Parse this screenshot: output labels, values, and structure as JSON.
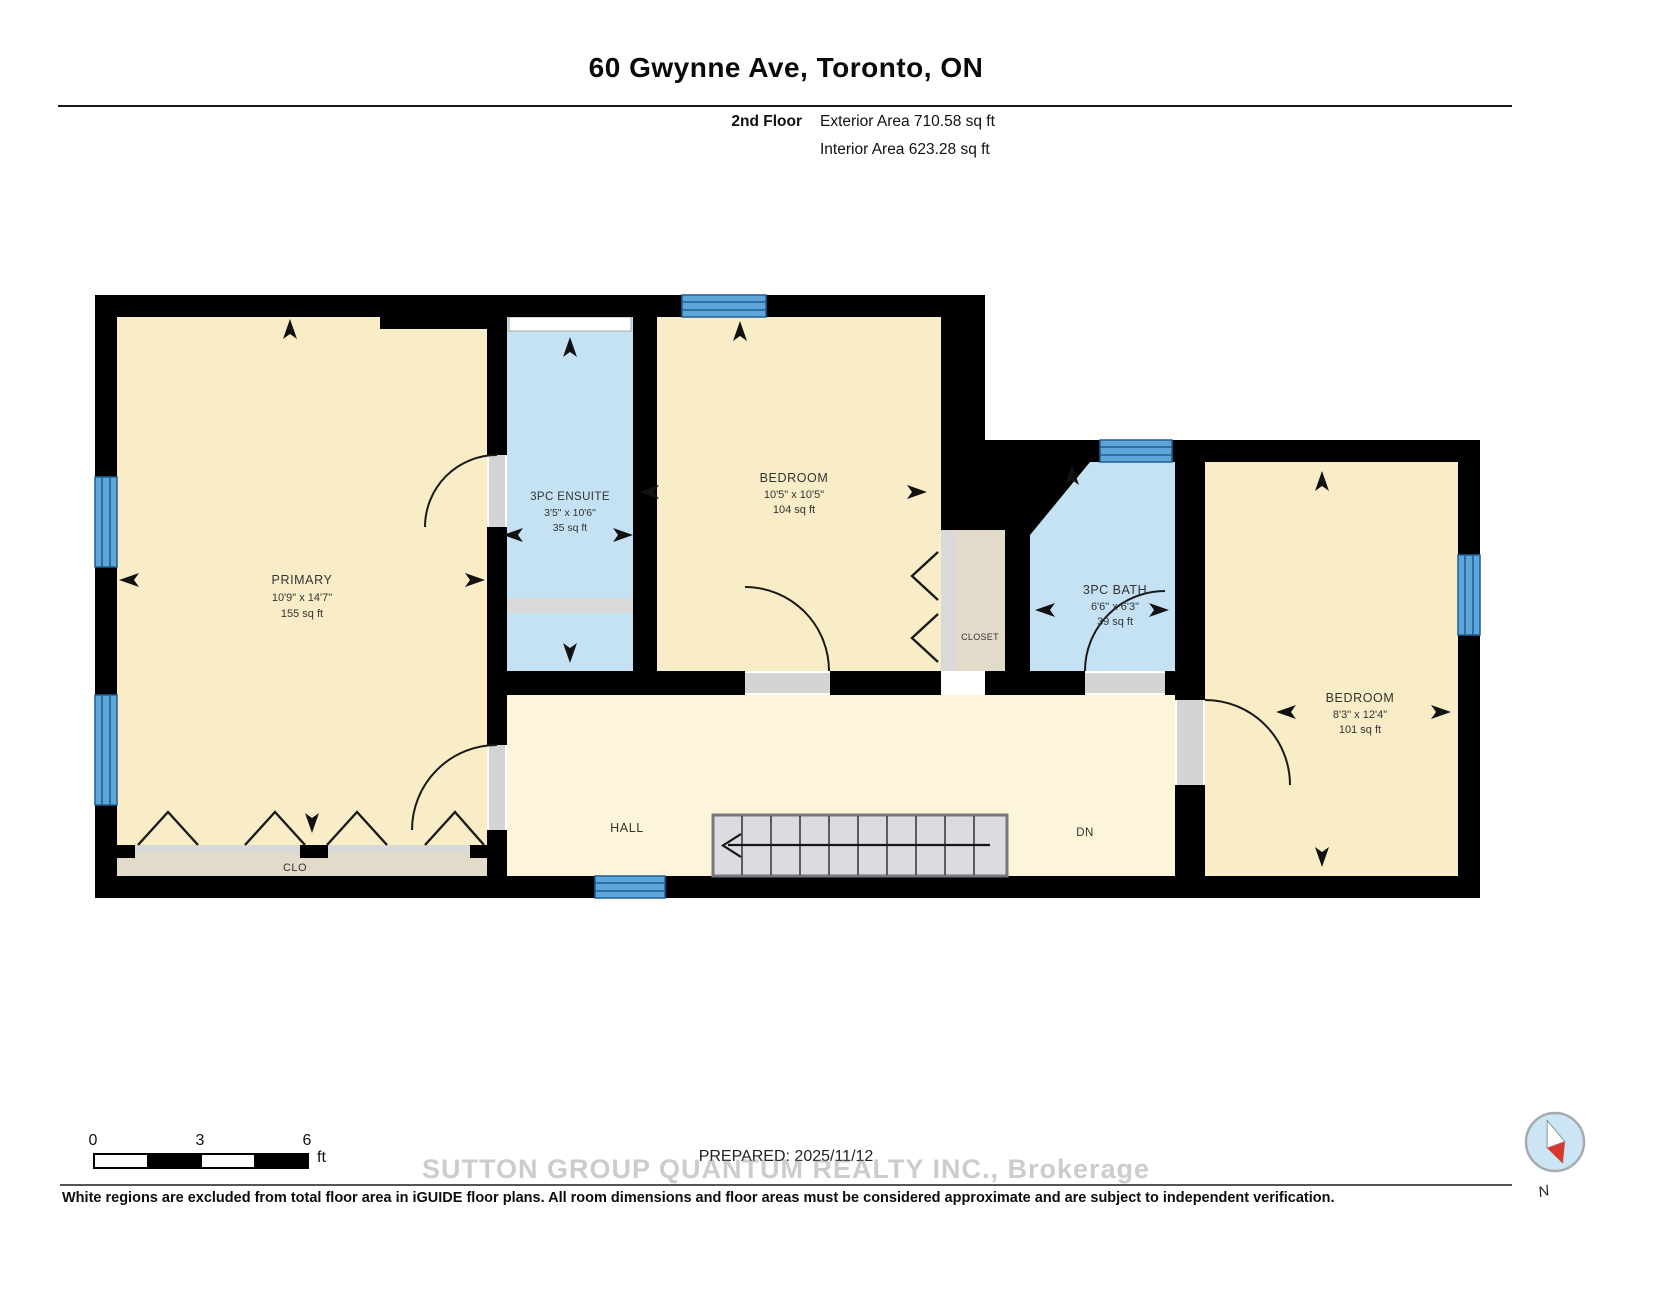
{
  "header": {
    "title": "60 Gwynne Ave, Toronto, ON",
    "floor_label": "2nd Floor",
    "exterior_area": "Exterior Area 710.58 sq ft",
    "interior_area": "Interior Area 623.28 sq ft"
  },
  "rooms": {
    "primary": {
      "name": "PRIMARY",
      "dims": "10'9\" x 14'7\"",
      "area": "155 sq ft"
    },
    "ensuite": {
      "name": "3PC ENSUITE",
      "dims": "3'5\" x 10'6\"",
      "area": "35 sq ft"
    },
    "bedroom1": {
      "name": "BEDROOM",
      "dims": "10'5\" x 10'5\"",
      "area": "104 sq ft"
    },
    "bath": {
      "name": "3PC BATH",
      "dims": "6'6\" x 6'3\"",
      "area": "39 sq ft"
    },
    "bedroom2": {
      "name": "BEDROOM",
      "dims": "8'3\" x 12'4\"",
      "area": "101 sq ft"
    },
    "hall": {
      "name": "HALL"
    },
    "closet": {
      "name": "CLOSET"
    },
    "clo": {
      "name": "CLO"
    },
    "stairs_label": "DN"
  },
  "scale_bar": {
    "tick0": "0",
    "tick1": "3",
    "tick2": "6",
    "unit": "ft"
  },
  "prepared": "PREPARED: 2025/11/12",
  "watermark": "SUTTON GROUP QUANTUM REALTY INC., Brokerage",
  "disclaimer": "White regions are excluded from total floor area in iGUIDE floor plans. All room dimensions and floor areas must be considered approximate and are subject to independent verification.",
  "compass": {
    "north_label": "N"
  },
  "colors": {
    "room_cream": "#F8EDC6",
    "hall_cream": "#FCF5DA",
    "wet_room_blue": "#C5E2F4",
    "closet_tan": "#E3DBC9",
    "window_blue": "#5EA6D8",
    "window_stripe": "#1F5F96",
    "wall_black": "#000000",
    "stairs_gray": "#DCDCE0",
    "compass_red": "#D63A2F"
  }
}
